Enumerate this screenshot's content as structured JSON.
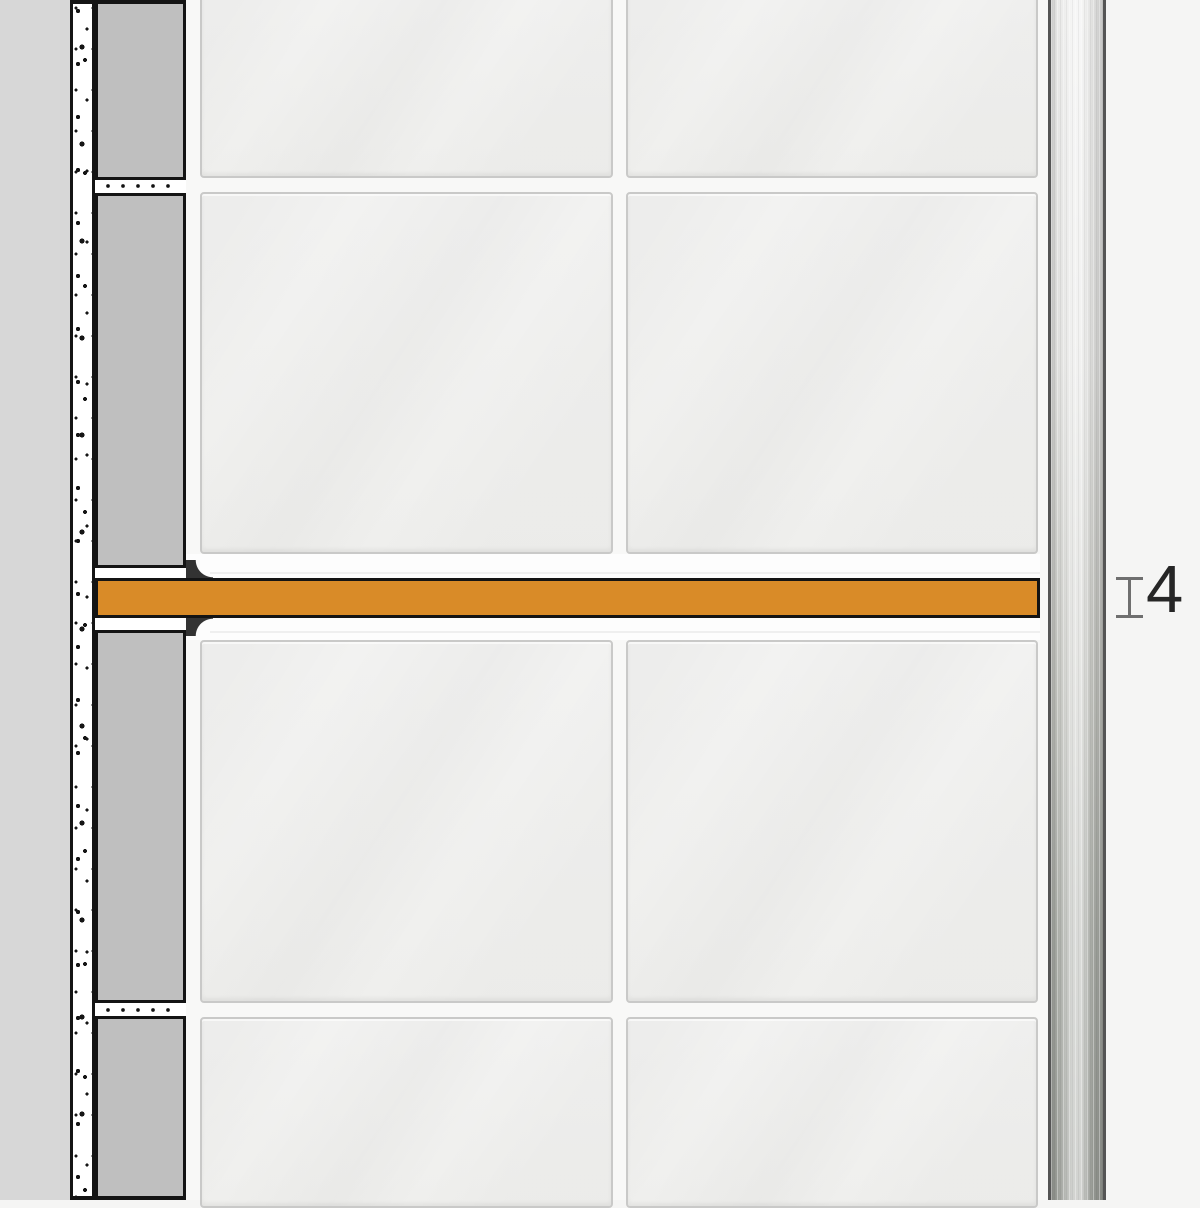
{
  "annotation": {
    "thickness_value": "4"
  },
  "icons": {
    "gauge": "thickness-gauge-icon"
  },
  "colors": {
    "shelf_orange": "#D98B28",
    "outline": "#141414",
    "wall_gray": "#D7D7D7",
    "block_gray": "#BFBFBF",
    "mortar_white": "#FFFFFF",
    "tile_face": "#EFEFED",
    "tile_border": "#C9C9C8",
    "grout": "#F8F8F7",
    "shelf_zone_white": "#FDFDFD",
    "metal_top": "#ECECEB",
    "metal_bottom": "#9B9E98",
    "metal_edge": "#555555",
    "gauge_gray": "#6F6F6F",
    "dim_text": "#262626",
    "background_right": "#F5F5F4"
  }
}
